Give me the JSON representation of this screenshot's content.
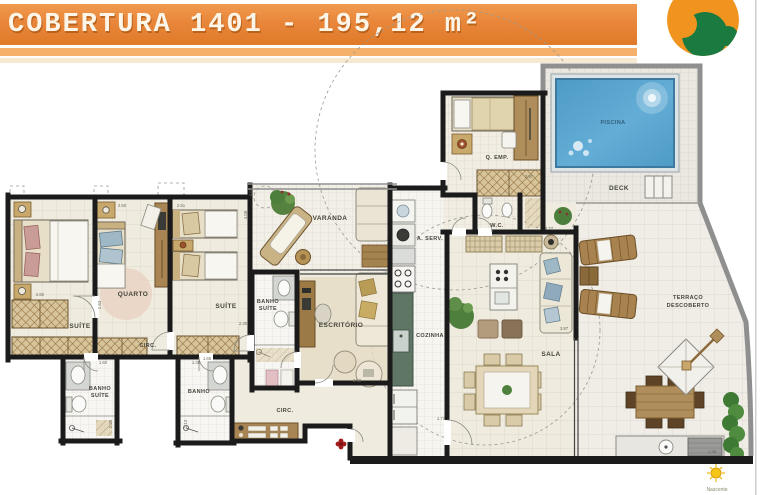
{
  "header": {
    "title": "COBERTURA 1401 - 195,12 m²"
  },
  "logo": {
    "name": "nascente-swirl-logo",
    "orange": "#F0941F",
    "green": "#1A7A40"
  },
  "colors": {
    "banner_orange": "#E8863A",
    "wall_black": "#1B1B1B",
    "pool_blue": "#5FA8CE",
    "entry_red": "#A11C1C",
    "floor_cream": "#EFEBDF"
  },
  "rooms": {
    "suite1": {
      "label": "SUÍTE"
    },
    "quarto": {
      "label": "QUARTO"
    },
    "suite2": {
      "label": "SUÍTE"
    },
    "circ_upper": {
      "label": "CIRC."
    },
    "banho_suite_left": {
      "line1": "BANHO",
      "line2": "SUÍTE"
    },
    "banho": {
      "label": "BANHO"
    },
    "banho_suite_mid": {
      "line1": "BANHO",
      "line2": "SUÍTE"
    },
    "varanda": {
      "label": "VARANDA"
    },
    "escritorio": {
      "label": "ESCRITÓRIO"
    },
    "area_servico": {
      "label": "A. SERV."
    },
    "wc": {
      "label": "W.C."
    },
    "cozinha": {
      "label": "COZINHA"
    },
    "quarto_empregada": {
      "label": "Q. EMP."
    },
    "piscina": {
      "label": "PISCINA"
    },
    "deck": {
      "label": "DECK"
    },
    "sala": {
      "label": "SALA"
    },
    "terraco": {
      "line1": "TERRAÇO",
      "line2": "DESCOBERTO"
    },
    "circ_lower": {
      "label": "CIRC."
    }
  },
  "compass": {
    "label": "Nascente"
  },
  "dimensions": [
    {
      "value": "2.82"
    },
    {
      "value": "2.50"
    },
    {
      "value": "2.51"
    },
    {
      "value": "4.08"
    },
    {
      "value": "2.30"
    },
    {
      "value": "1.63"
    },
    {
      "value": "1.60"
    },
    {
      "value": "2.35"
    },
    {
      "value": "1.30"
    },
    {
      "value": "2.13"
    },
    {
      "value": "2.97"
    },
    {
      "value": "4.77"
    },
    {
      "value": "3.87"
    },
    {
      "value": "2.90"
    },
    {
      "value": "1.77"
    },
    {
      "value": "4.02"
    },
    {
      "value": "1.65"
    },
    {
      "value": "1.38"
    }
  ]
}
